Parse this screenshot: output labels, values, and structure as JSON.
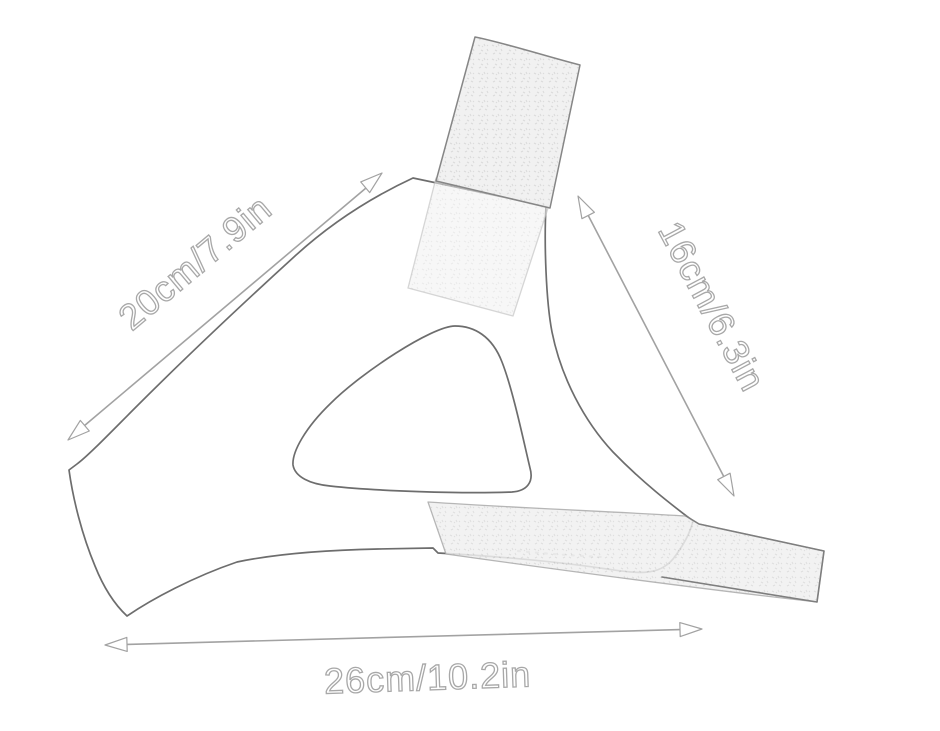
{
  "canvas": {
    "background": "#ffffff"
  },
  "diagram": {
    "kind": "product-dimension-sketch",
    "subject": "chin-strap line drawing with velcro straps and triangular opening",
    "colors": {
      "product_outline": "#6d6d6d",
      "dimension_line": "#a2a2a2",
      "label_outline": "#a8a8a8",
      "label_fill": "#ffffff",
      "velcro_fill": "#f0f0f0",
      "velcro_speckle": "#d8d8d8"
    },
    "dimensions": [
      {
        "id": "upper-left-edge",
        "label": "20cm/7.9in",
        "value_cm": 20,
        "value_in": 7.9,
        "orientation_deg": -40
      },
      {
        "id": "right-edge",
        "label": "16cm/6.3in",
        "value_cm": 16,
        "value_in": 6.3,
        "orientation_deg": 62
      },
      {
        "id": "bottom-edge",
        "label": "26cm/10.2in",
        "value_cm": 26,
        "value_in": 10.2,
        "orientation_deg": -2
      }
    ]
  }
}
